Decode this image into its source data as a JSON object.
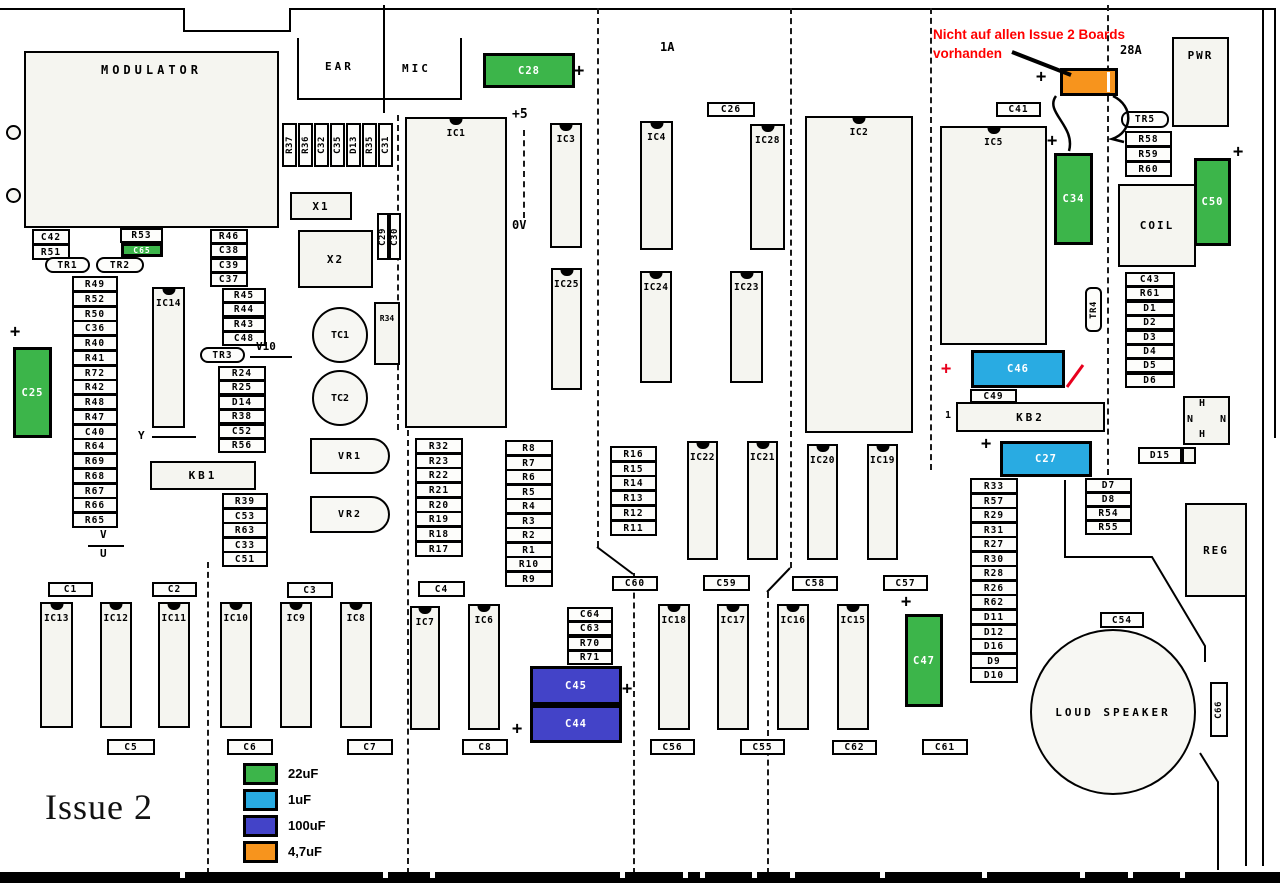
{
  "title": "Issue 2",
  "annotation": {
    "line1": "Nicht auf allen Issue 2 Boards",
    "line2": "vorhanden",
    "color": "#ff0000"
  },
  "colors": {
    "green": "#3CB54A",
    "blue": "#29ABE2",
    "navy": "#4343C8",
    "orange": "#F7941D",
    "black": "#000000",
    "red": "#E8001C"
  },
  "legend": {
    "x": 243,
    "y": 763,
    "row_gap": 26,
    "swatch_w": 35,
    "swatch_h": 22,
    "items": [
      {
        "label": "22uF",
        "color_key": "green"
      },
      {
        "label": "1uF",
        "color_key": "blue"
      },
      {
        "label": "100uF",
        "color_key": "navy"
      },
      {
        "label": "4,7uF",
        "color_key": "orange"
      }
    ]
  },
  "label_columns": [
    {
      "name": "col-under-modulator",
      "x": 32,
      "y": 229,
      "w": 38,
      "rh": 15,
      "items": [
        "C42",
        "R51"
      ]
    },
    {
      "name": "col-r46",
      "x": 210,
      "y": 229,
      "w": 38,
      "rh": 14.4,
      "items": [
        "R46",
        "C38",
        "C39",
        "C37"
      ]
    },
    {
      "name": "col-r45",
      "x": 222,
      "y": 288,
      "w": 44,
      "rh": 14.4,
      "items": [
        "R45",
        "R44",
        "R43",
        "C48"
      ]
    },
    {
      "name": "col-r24",
      "x": 218,
      "y": 366,
      "w": 48,
      "rh": 14.4,
      "items": [
        "R24",
        "R25",
        "D14",
        "R38",
        "C52",
        "R56"
      ]
    },
    {
      "name": "col-r39",
      "x": 222,
      "y": 493,
      "w": 46,
      "rh": 14.6,
      "items": [
        "R39",
        "C53",
        "R63",
        "C33",
        "C51"
      ]
    },
    {
      "name": "col-left",
      "x": 72,
      "y": 276,
      "w": 46,
      "rh": 14.75,
      "items": [
        "R49",
        "R52",
        "R50",
        "C36",
        "R40",
        "R41",
        "R72",
        "R42",
        "R48",
        "R47",
        "C40",
        "R64",
        "R69",
        "R68",
        "R67",
        "R66",
        "R65"
      ]
    },
    {
      "name": "col-r32",
      "x": 415,
      "y": 438,
      "w": 48,
      "rh": 14.65,
      "items": [
        "R32",
        "R23",
        "R22",
        "R21",
        "R20",
        "R19",
        "R18",
        "R17"
      ]
    },
    {
      "name": "col-r8",
      "x": 505,
      "y": 440,
      "w": 48,
      "rh": 14.55,
      "items": [
        "R8",
        "R7",
        "R6",
        "R5",
        "R4",
        "R3",
        "R2",
        "R1",
        "R10",
        "R9"
      ]
    },
    {
      "name": "col-r16",
      "x": 610,
      "y": 446,
      "w": 47,
      "rh": 14.7,
      "items": [
        "R16",
        "R15",
        "R14",
        "R13",
        "R12",
        "R11"
      ]
    },
    {
      "name": "col-c64",
      "x": 567,
      "y": 607,
      "w": 46,
      "rh": 14.4,
      "items": [
        "C64",
        "C63",
        "R70",
        "R71"
      ]
    },
    {
      "name": "col-c43",
      "x": 1125,
      "y": 272,
      "w": 50,
      "rh": 14.4,
      "items": [
        "C43",
        "R61",
        "D1",
        "D2",
        "D3",
        "D4",
        "D5",
        "D6"
      ]
    },
    {
      "name": "col-r33",
      "x": 970,
      "y": 478,
      "w": 48,
      "rh": 14.55,
      "items": [
        "R33",
        "R57",
        "R29",
        "R31",
        "R27",
        "R30",
        "R28",
        "R26",
        "R62",
        "D11",
        "D12",
        "D16",
        "D9",
        "D10"
      ]
    },
    {
      "name": "col-d7",
      "x": 1085,
      "y": 478,
      "w": 47,
      "rh": 14,
      "items": [
        "D7",
        "D8",
        "R54",
        "R55"
      ]
    },
    {
      "name": "col-r58",
      "x": 1125,
      "y": 131,
      "w": 47,
      "rh": 15,
      "items": [
        "R58",
        "R59",
        "R60"
      ]
    }
  ],
  "vertical_row": {
    "x": 282,
    "y": 123,
    "bw": 15,
    "gap": 16,
    "h": 44,
    "items": [
      "R37",
      "R36",
      "C32",
      "C35",
      "D13",
      "R35",
      "C31"
    ]
  },
  "vboxes": [
    {
      "t": "C29",
      "x": 377,
      "y": 213,
      "w": 12,
      "h": 47
    },
    {
      "t": "C30",
      "x": 389,
      "y": 213,
      "w": 12,
      "h": 47
    },
    {
      "t": "TR4",
      "x": 1085,
      "y": 287,
      "w": 17,
      "h": 45,
      "rad": 6
    },
    {
      "t": "C66",
      "x": 1210,
      "y": 682,
      "w": 18,
      "h": 55
    }
  ],
  "labels": [
    {
      "t": "R53",
      "x": 120,
      "y": 228,
      "w": 43,
      "h": 15
    },
    {
      "t": "C41",
      "x": 996,
      "y": 102,
      "w": 45,
      "h": 15
    },
    {
      "t": "C26",
      "x": 707,
      "y": 102,
      "w": 48,
      "h": 15
    },
    {
      "t": "C49",
      "x": 970,
      "y": 389,
      "w": 47,
      "h": 14
    },
    {
      "t": "D15",
      "x": 1138,
      "y": 447,
      "w": 44,
      "h": 17
    },
    {
      "t": "C54",
      "x": 1100,
      "y": 612,
      "w": 44,
      "h": 16
    },
    {
      "t": "C1",
      "x": 48,
      "y": 582,
      "w": 45,
      "h": 15
    },
    {
      "t": "C2",
      "x": 152,
      "y": 582,
      "w": 45,
      "h": 15
    },
    {
      "t": "C3",
      "x": 287,
      "y": 582,
      "w": 46,
      "h": 16
    },
    {
      "t": "C4",
      "x": 418,
      "y": 581,
      "w": 47,
      "h": 16
    },
    {
      "t": "C5",
      "x": 107,
      "y": 739,
      "w": 48,
      "h": 16
    },
    {
      "t": "C6",
      "x": 227,
      "y": 739,
      "w": 46,
      "h": 16
    },
    {
      "t": "C7",
      "x": 347,
      "y": 739,
      "w": 46,
      "h": 16
    },
    {
      "t": "C8",
      "x": 462,
      "y": 739,
      "w": 46,
      "h": 16
    },
    {
      "t": "C60",
      "x": 612,
      "y": 576,
      "w": 46,
      "h": 15
    },
    {
      "t": "C59",
      "x": 703,
      "y": 575,
      "w": 47,
      "h": 16
    },
    {
      "t": "C58",
      "x": 792,
      "y": 576,
      "w": 46,
      "h": 15
    },
    {
      "t": "C57",
      "x": 883,
      "y": 575,
      "w": 45,
      "h": 16
    },
    {
      "t": "C56",
      "x": 650,
      "y": 739,
      "w": 45,
      "h": 16
    },
    {
      "t": "C55",
      "x": 740,
      "y": 739,
      "w": 45,
      "h": 16
    },
    {
      "t": "C62",
      "x": 832,
      "y": 740,
      "w": 45,
      "h": 15
    },
    {
      "t": "C61",
      "x": 922,
      "y": 739,
      "w": 46,
      "h": 16
    }
  ],
  "big_boxes": [
    {
      "t": "MODULATOR",
      "x": 24,
      "y": 51,
      "w": 255,
      "h": 177,
      "lt": true,
      "fs": 12,
      "ls": 4
    },
    {
      "t": "PWR",
      "x": 1172,
      "y": 37,
      "w": 57,
      "h": 90,
      "lt": true,
      "ls": 2
    },
    {
      "t": "COIL",
      "x": 1118,
      "y": 184,
      "w": 78,
      "h": 83,
      "ls": 2
    },
    {
      "t": "REG",
      "x": 1185,
      "y": 503,
      "w": 62,
      "h": 94,
      "ls": 2
    },
    {
      "t": "KB1",
      "x": 150,
      "y": 461,
      "w": 106,
      "h": 29,
      "ls": 3
    },
    {
      "t": "KB2",
      "x": 956,
      "y": 402,
      "w": 149,
      "h": 30,
      "ls": 3
    },
    {
      "t": "X1",
      "x": 290,
      "y": 192,
      "w": 62,
      "h": 28,
      "ls": 2
    },
    {
      "t": "X2",
      "x": 298,
      "y": 230,
      "w": 75,
      "h": 58,
      "ls": 2
    },
    {
      "t": "R34",
      "x": 374,
      "y": 302,
      "w": 26,
      "h": 63,
      "lt": true,
      "fs": 8,
      "ls": 0
    },
    {
      "t": "",
      "x": 1182,
      "y": 447,
      "w": 14,
      "h": 17
    },
    {
      "t": "",
      "x": 1183,
      "y": 396,
      "w": 47,
      "h": 49
    }
  ],
  "chips": [
    {
      "t": "IC1",
      "x": 405,
      "y": 117,
      "w": 102,
      "h": 311
    },
    {
      "t": "IC2",
      "x": 805,
      "y": 116,
      "w": 108,
      "h": 317
    },
    {
      "t": "IC5",
      "x": 940,
      "y": 126,
      "w": 107,
      "h": 219
    },
    {
      "t": "IC14",
      "x": 152,
      "y": 287,
      "w": 33,
      "h": 141
    },
    {
      "t": "IC3",
      "x": 550,
      "y": 123,
      "w": 32,
      "h": 125
    },
    {
      "t": "IC25",
      "x": 551,
      "y": 268,
      "w": 31,
      "h": 122
    },
    {
      "t": "IC4",
      "x": 640,
      "y": 121,
      "w": 33,
      "h": 129
    },
    {
      "t": "IC28",
      "x": 750,
      "y": 124,
      "w": 35,
      "h": 126
    },
    {
      "t": "IC24",
      "x": 640,
      "y": 271,
      "w": 32,
      "h": 112
    },
    {
      "t": "IC23",
      "x": 730,
      "y": 271,
      "w": 33,
      "h": 112
    },
    {
      "t": "IC22",
      "x": 687,
      "y": 441,
      "w": 31,
      "h": 119
    },
    {
      "t": "IC21",
      "x": 747,
      "y": 441,
      "w": 31,
      "h": 119
    },
    {
      "t": "IC20",
      "x": 807,
      "y": 444,
      "w": 31,
      "h": 116
    },
    {
      "t": "IC19",
      "x": 867,
      "y": 444,
      "w": 31,
      "h": 116
    },
    {
      "t": "IC13",
      "x": 40,
      "y": 602,
      "w": 33,
      "h": 126
    },
    {
      "t": "IC12",
      "x": 100,
      "y": 602,
      "w": 32,
      "h": 126
    },
    {
      "t": "IC11",
      "x": 158,
      "y": 602,
      "w": 32,
      "h": 126
    },
    {
      "t": "IC10",
      "x": 220,
      "y": 602,
      "w": 32,
      "h": 126
    },
    {
      "t": "IC9",
      "x": 280,
      "y": 602,
      "w": 32,
      "h": 126
    },
    {
      "t": "IC8",
      "x": 340,
      "y": 602,
      "w": 32,
      "h": 126
    },
    {
      "t": "IC7",
      "x": 410,
      "y": 606,
      "w": 30,
      "h": 124
    },
    {
      "t": "IC6",
      "x": 468,
      "y": 604,
      "w": 32,
      "h": 126
    },
    {
      "t": "IC18",
      "x": 658,
      "y": 604,
      "w": 32,
      "h": 126
    },
    {
      "t": "IC17",
      "x": 717,
      "y": 604,
      "w": 32,
      "h": 126
    },
    {
      "t": "IC16",
      "x": 777,
      "y": 604,
      "w": 32,
      "h": 126
    },
    {
      "t": "IC15",
      "x": 837,
      "y": 604,
      "w": 32,
      "h": 126
    }
  ],
  "caps": [
    {
      "t": "C65",
      "c": "green",
      "x": 121,
      "y": 243,
      "w": 42,
      "h": 14,
      "fs": 8
    },
    {
      "t": "C25",
      "c": "green",
      "x": 13,
      "y": 347,
      "w": 39,
      "h": 91
    },
    {
      "t": "C28",
      "c": "green",
      "x": 483,
      "y": 53,
      "w": 92,
      "h": 35
    },
    {
      "t": "C34",
      "c": "green",
      "x": 1054,
      "y": 153,
      "w": 39,
      "h": 92
    },
    {
      "t": "C50",
      "c": "green",
      "x": 1194,
      "y": 158,
      "w": 37,
      "h": 88
    },
    {
      "t": "C47",
      "c": "green",
      "x": 905,
      "y": 614,
      "w": 38,
      "h": 93
    },
    {
      "t": "C46",
      "c": "blue",
      "x": 971,
      "y": 350,
      "w": 94,
      "h": 38
    },
    {
      "t": "C27",
      "c": "blue",
      "x": 1000,
      "y": 441,
      "w": 92,
      "h": 36
    },
    {
      "t": "C45",
      "c": "navy",
      "x": 530,
      "y": 666,
      "w": 92,
      "h": 39
    },
    {
      "t": "C44",
      "c": "navy",
      "x": 530,
      "y": 705,
      "w": 92,
      "h": 38
    },
    {
      "t": "",
      "c": "orange",
      "x": 1060,
      "y": 68,
      "w": 58,
      "h": 28,
      "stripe": 44
    }
  ],
  "rounded": [
    {
      "t": "TR1",
      "x": 45,
      "y": 257,
      "w": 45,
      "h": 16
    },
    {
      "t": "TR2",
      "x": 96,
      "y": 257,
      "w": 48,
      "h": 16
    },
    {
      "t": "TR3",
      "x": 200,
      "y": 347,
      "w": 45,
      "h": 16
    },
    {
      "t": "TR5",
      "x": 1121,
      "y": 111,
      "w": 48,
      "h": 17
    }
  ],
  "vr_shapes": [
    {
      "t": "VR1",
      "x": 310,
      "y": 438,
      "w": 80,
      "h": 36
    },
    {
      "t": "VR2",
      "x": 310,
      "y": 496,
      "w": 80,
      "h": 37
    }
  ],
  "circles": [
    {
      "t": "",
      "x": 6,
      "y": 125,
      "d": 15
    },
    {
      "t": "",
      "x": 6,
      "y": 188,
      "d": 15
    },
    {
      "t": "TC1",
      "x": 312,
      "y": 307,
      "d": 56,
      "fs": 10
    },
    {
      "t": "TC2",
      "x": 312,
      "y": 370,
      "d": 56,
      "fs": 10
    },
    {
      "t": "LOUD SPEAKER",
      "x": 1030,
      "y": 629,
      "d": 166,
      "fs": 11,
      "ls": 3
    }
  ],
  "texts": [
    {
      "t": "EAR",
      "x": 325,
      "y": 60,
      "fs": 11,
      "ls": 3
    },
    {
      "t": "MIC",
      "x": 402,
      "y": 62,
      "fs": 11,
      "ls": 3
    },
    {
      "t": "+5",
      "x": 512,
      "y": 107,
      "fs": 13
    },
    {
      "t": "0V",
      "x": 512,
      "y": 218,
      "fs": 12
    },
    {
      "t": "1A",
      "x": 660,
      "y": 40,
      "fs": 12
    },
    {
      "t": "28A",
      "x": 1120,
      "y": 43,
      "fs": 12
    },
    {
      "t": "Y",
      "x": 138,
      "y": 429,
      "fs": 11
    },
    {
      "t": "V10",
      "x": 256,
      "y": 340,
      "fs": 11
    },
    {
      "t": "V",
      "x": 100,
      "y": 528,
      "fs": 11
    },
    {
      "t": "U",
      "x": 100,
      "y": 547,
      "fs": 11
    },
    {
      "t": "1",
      "x": 945,
      "y": 410,
      "fs": 10
    },
    {
      "t": "H",
      "x": 1199,
      "y": 398,
      "fs": 10
    },
    {
      "t": "N",
      "x": 1187,
      "y": 414,
      "fs": 10
    },
    {
      "t": "N",
      "x": 1220,
      "y": 414,
      "fs": 10
    },
    {
      "t": "H",
      "x": 1199,
      "y": 429,
      "fs": 10
    }
  ],
  "pluses": [
    {
      "x": 10,
      "y": 324,
      "c": "black"
    },
    {
      "x": 574,
      "y": 63,
      "c": "black"
    },
    {
      "x": 901,
      "y": 594,
      "c": "black"
    },
    {
      "x": 622,
      "y": 681,
      "c": "black"
    },
    {
      "x": 512,
      "y": 721,
      "c": "black"
    },
    {
      "x": 1036,
      "y": 69,
      "c": "black"
    },
    {
      "x": 1047,
      "y": 133,
      "c": "black"
    },
    {
      "x": 1233,
      "y": 144,
      "c": "black"
    },
    {
      "x": 981,
      "y": 436,
      "c": "black"
    },
    {
      "x": 941,
      "y": 361,
      "c": "red"
    }
  ],
  "lines": [
    {
      "x": 0,
      "y": 8,
      "w": 183,
      "h": 2,
      "s": "s"
    },
    {
      "x": 183,
      "y": 8,
      "w": 2,
      "h": 24,
      "s": "s"
    },
    {
      "x": 183,
      "y": 30,
      "w": 108,
      "h": 2,
      "s": "s"
    },
    {
      "x": 289,
      "y": 8,
      "w": 2,
      "h": 24,
      "s": "s"
    },
    {
      "x": 289,
      "y": 8,
      "w": 987,
      "h": 2,
      "s": "s"
    },
    {
      "x": 297,
      "y": 38,
      "w": 2,
      "h": 62,
      "s": "s"
    },
    {
      "x": 297,
      "y": 98,
      "w": 165,
      "h": 2,
      "s": "s"
    },
    {
      "x": 460,
      "y": 38,
      "w": 2,
      "h": 62,
      "s": "s"
    },
    {
      "x": 383,
      "y": 5,
      "w": 2,
      "h": 108,
      "s": "s"
    },
    {
      "x": 1274,
      "y": 8,
      "w": 2,
      "h": 430,
      "s": "s"
    },
    {
      "x": 1262,
      "y": 8,
      "w": 2,
      "h": 858,
      "s": "s"
    },
    {
      "x": 1245,
      "y": 560,
      "w": 2,
      "h": 306,
      "s": "s"
    },
    {
      "x": 152,
      "y": 436,
      "w": 44,
      "h": 2,
      "s": "s"
    },
    {
      "x": 250,
      "y": 356,
      "w": 42,
      "h": 2,
      "s": "s"
    },
    {
      "x": 88,
      "y": 545,
      "w": 36,
      "h": 2,
      "s": "s"
    },
    {
      "x": 597,
      "y": 8,
      "w": 2,
      "h": 539,
      "s": "d"
    },
    {
      "x": 633,
      "y": 573,
      "w": 2,
      "h": 301,
      "s": "d"
    },
    {
      "x": 790,
      "y": 8,
      "w": 2,
      "h": 560,
      "s": "d"
    },
    {
      "x": 767,
      "y": 592,
      "w": 2,
      "h": 282,
      "s": "d"
    },
    {
      "x": 930,
      "y": 8,
      "w": 2,
      "h": 462,
      "s": "d"
    },
    {
      "x": 1107,
      "y": 5,
      "w": 2,
      "h": 470,
      "s": "d"
    },
    {
      "x": 397,
      "y": 115,
      "w": 2,
      "h": 315,
      "s": "d"
    },
    {
      "x": 407,
      "y": 430,
      "w": 2,
      "h": 444,
      "s": "d"
    },
    {
      "x": 207,
      "y": 562,
      "w": 2,
      "h": 312,
      "s": "d"
    },
    {
      "x": 523,
      "y": 130,
      "w": 2,
      "h": 88,
      "s": "d"
    }
  ],
  "svg_paths": [
    {
      "name": "annotation-arrow",
      "d": "M1012,52 L1071,75",
      "w": 4,
      "c": "#000000"
    },
    {
      "name": "wire-left",
      "d": "M1056,96 C1044,112 1076,126 1069,151",
      "w": 2.5,
      "c": "#000000"
    },
    {
      "name": "wire-right",
      "d": "M1113,96 C1134,106 1133,132 1112,139 L1124,142",
      "w": 2.5,
      "c": "#000000"
    },
    {
      "name": "red-slash",
      "d": "M1067,387 L1083,365",
      "w": 3,
      "c": "#E8001C"
    },
    {
      "name": "jog-left",
      "d": "M597,547 L633,574",
      "w": 2,
      "c": "#000000"
    },
    {
      "name": "jog-right",
      "d": "M790,568 L767,592",
      "w": 2,
      "c": "#000000"
    },
    {
      "name": "board-cut-1",
      "d": "M1065,480 L1065,557 L1152,557 L1205,646 L1205,662",
      "w": 2,
      "c": "#000000"
    },
    {
      "name": "board-cut-2",
      "d": "M1200,753 L1218,782 L1218,870",
      "w": 2,
      "c": "#000000"
    }
  ],
  "edge_connector": {
    "y": 872,
    "h": 11,
    "notches": [
      180,
      383,
      430,
      620,
      683,
      700,
      752,
      790,
      880,
      982,
      1080,
      1128,
      1180
    ]
  }
}
